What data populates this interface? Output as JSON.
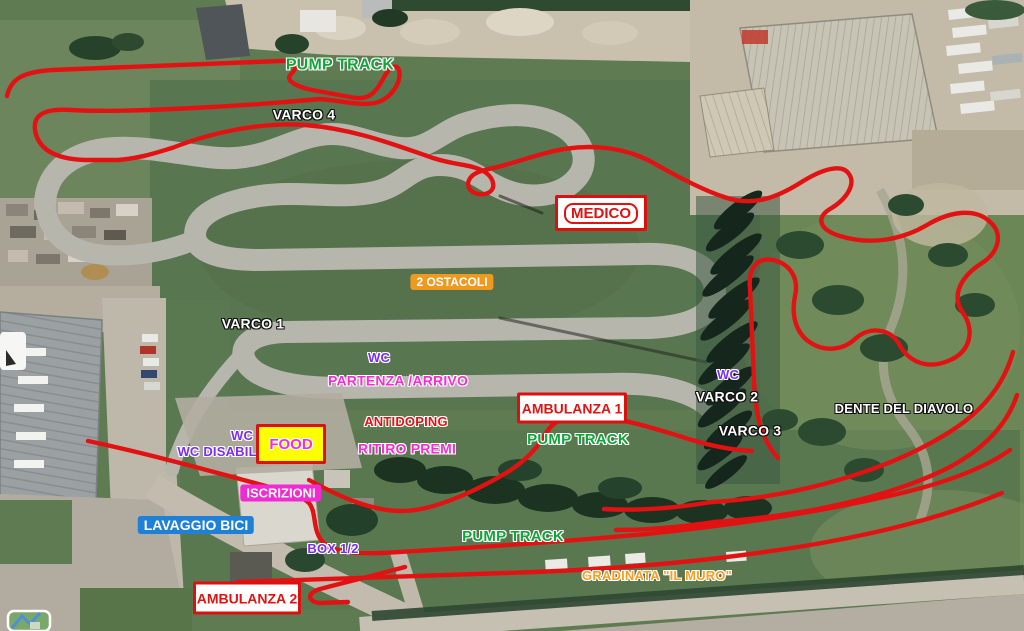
{
  "map": {
    "type": "satellite-course-map",
    "course_color": "#e31212",
    "colors": {
      "track_asphalt": "#b6b6ad",
      "grass": "#5f7b52",
      "gravel_yard": "#c9c0ae",
      "label_green": "#12a53a",
      "label_violet": "#7b2df2",
      "label_magenta": "#f82bd6",
      "label_red": "#e31212",
      "label_orange": "#ff9d1e",
      "badge_blue": "#1f80d8",
      "badge_orange": "#f0991f",
      "badge_magenta": "#ef2bd2",
      "food_bg": "#ffff00"
    },
    "labels": {
      "pump_track_top": "PUMP TRACK",
      "varco_4": "VARCO 4",
      "medico": "MEDICO",
      "ostacoli": "2 OSTACOLI",
      "varco_1": "VARCO 1",
      "wc_center": "WC",
      "partenza": "PARTENZA /ARRIVO",
      "ambulanza_1": "AMBULANZA 1",
      "pump_track_mid": "PUMP TRACK",
      "wc_right": "WC",
      "varco_2": "VARCO 2",
      "varco_3": "VARCO 3",
      "dente": "DENTE DEL DIAVOLO",
      "wc_left": "WC",
      "wc_disabili": "WC DISABILI",
      "food": "FOOD",
      "antidoping": "ANTIDOPING",
      "ritiro_premi": "RITIRO PREMI",
      "iscrizioni": "ISCRIZIONI",
      "lavaggio_bici": "LAVAGGIO BICI",
      "box_12": "BOX 1/2",
      "pump_track_bottom": "PUMP TRACK",
      "gradinata": "GRADINATA \"IL MURO\"",
      "ambulanza_2": "AMBULANZA 2"
    }
  }
}
